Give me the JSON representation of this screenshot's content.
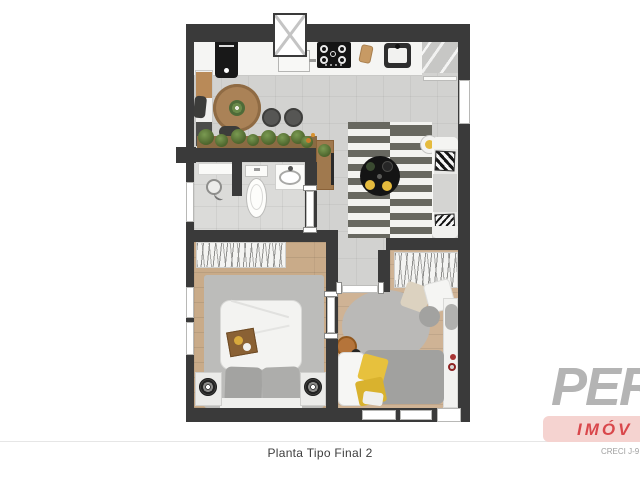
{
  "caption": {
    "text": "Planta Tipo Final 2"
  },
  "logo": {
    "brand_visible": "PER",
    "division_visible": "IMÓV",
    "creci_visible": "CRECI J-9",
    "brand_color": "#b4b4b4",
    "division_color": "#d9474b",
    "band_color": "#f5d3d0"
  },
  "floorplan": {
    "areas": [
      "kitchen-dining",
      "living-room",
      "bathroom",
      "bedroom",
      "multipurpose-room",
      "hall",
      "utility-shaft"
    ],
    "colors": {
      "wall": "#3a3a3a",
      "tile_floor": "#d2d2d0",
      "wood_floor": "#c9ab89",
      "rug_gray": "#bcbcba",
      "rug_stripe_dark": "#686860",
      "accent_yellow": "#e5bb3d",
      "plant_green": "#50682f",
      "furniture_wood": "#aa8257",
      "separator_line": "#e6e6e6"
    }
  }
}
